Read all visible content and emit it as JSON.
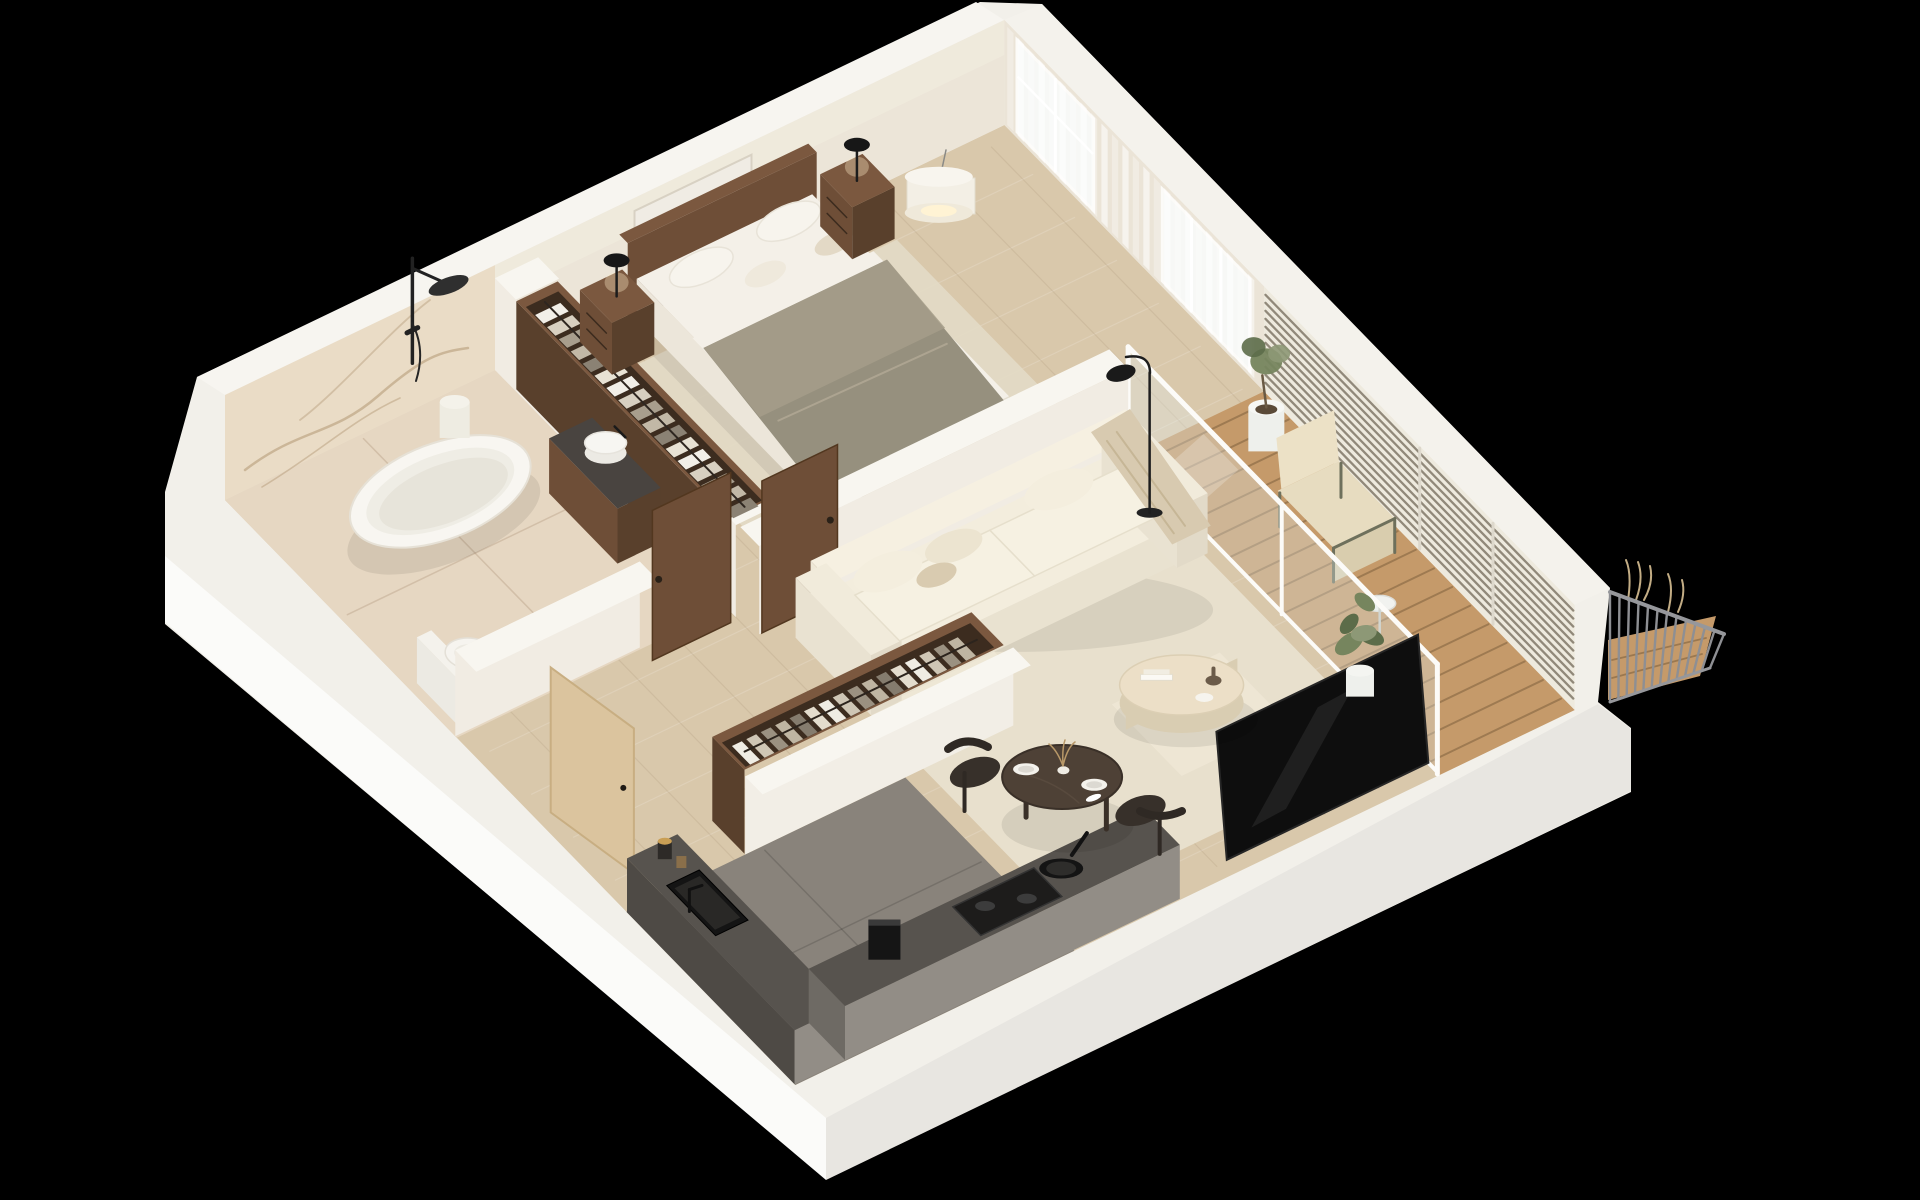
{
  "scene": {
    "label": "3D isometric cutaway floor plan render of a studio apartment",
    "background": "#000000",
    "rooms": [
      {
        "id": "bathroom",
        "items": [
          "marble-accent-wall",
          "rain-shower",
          "freestanding-bathtub",
          "wood-vanity-vessel-sink",
          "toilet",
          "laundry-basket",
          "bathroom-door"
        ]
      },
      {
        "id": "bedroom",
        "items": [
          "double-bed",
          "walnut-headboard",
          "nightstand-left",
          "nightstand-right",
          "black-table-lamps",
          "open-wardrobe-with-clothes",
          "abstract-artwork",
          "pendant-lamp",
          "windows-with-sheer-curtains",
          "foot-bench",
          "bedroom-door"
        ]
      },
      {
        "id": "living-room",
        "items": [
          "cream-sofa",
          "accent-cushions",
          "throw-blanket",
          "black-floor-lamp",
          "travertine-coffee-table",
          "tv-screen",
          "area-rug",
          "corner-plant",
          "sliding-glass-door"
        ]
      },
      {
        "id": "dining-area",
        "items": [
          "round-dark-wood-table",
          "two-dark-chairs",
          "plates",
          "dried-flower-vase"
        ]
      },
      {
        "id": "kitchen",
        "items": [
          "l-shaped-stone-counter",
          "black-sink",
          "black-faucet",
          "coffee-machine",
          "induction-cooktop",
          "black-pan",
          "storage-jars"
        ]
      },
      {
        "id": "entry-hall",
        "items": [
          "entry-door",
          "open-closet-with-clothes",
          "half-wall"
        ]
      },
      {
        "id": "balcony",
        "items": [
          "wood-deck",
          "slatted-privacy-screens",
          "lounge-chair",
          "potted-tree",
          "side-table",
          "metal-railing",
          "dried-grasses"
        ]
      }
    ]
  },
  "colors": {
    "bg": "#000000",
    "wallOuter": "#f2f0ea",
    "wallCapA": "#f7f5f0",
    "wallCapB": "#f4f2ec",
    "plinthBright": "#fbfbf9",
    "plinthShade": "#e8e6e1",
    "wallInner": "#ece5d8",
    "wallInnerB": "#ebe4d7",
    "wallPart": "#f1ece3",
    "wallPartCap": "#f8f6f0",
    "marble": "#eadcc6",
    "marbleVein": "#b59c79",
    "woodFloor": "#d9c8ab",
    "woodLine": "#b08c60",
    "bathFloor": "#e6d7c2",
    "kitchenFloor": "#89837b",
    "deck": "#c59a6a",
    "deckLine": "#8a6a45",
    "walnut": "#6e4e37",
    "walnutDark": "#59402c",
    "walnutDeep": "#3c2c1f",
    "walnutTop": "#7b583f",
    "duvet": "#96907e",
    "duvetLight": "#a69d8a",
    "linen": "#f4f0e8",
    "pillow": "#f7f4ed",
    "sofa": "#f3eddd",
    "sofaFace": "#e9e2d0",
    "sofaBack": "#f6f0e1",
    "cushion": "#d9cbb0",
    "rug": "#e8e0cd",
    "rugBed": "#e3dac5",
    "counterTop": "#57534e",
    "counterFace": "#928d86",
    "black": "#141414",
    "appliance": "#1d1c1b",
    "glassTint": "#e4eef0",
    "windowGlass": "#f7f8f6",
    "frame": "#fcfbf8",
    "curtain": "#ffffff",
    "slatWall": "#eeeade",
    "slatLine": "#7a7162",
    "plant": "#76855e",
    "plantDark": "#5c6c49",
    "plantLight": "#8d9876",
    "pot": "#eef0ec",
    "travertine": "#ecdfc7",
    "travertineSide": "#d9cdb2",
    "tableWood": "#4e4136",
    "chairDark": "#37302a",
    "railing": "#8e8f93",
    "dried": "#c3ad85",
    "bench": "#d3c2a8",
    "throw": "#d8cab0",
    "art": "#f0ece4",
    "artLine": "#8c8678",
    "doorOak": "#dbc49e",
    "doorOakEdge": "#c8ae82",
    "shadow": "rgba(0,0,0,0.08)"
  }
}
